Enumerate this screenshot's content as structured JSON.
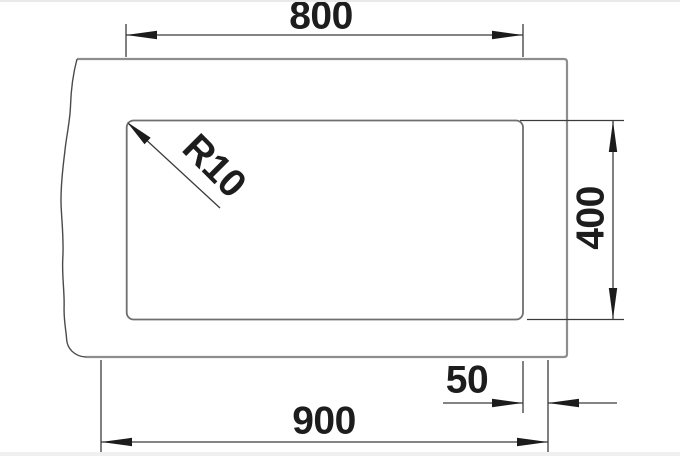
{
  "drawing": {
    "type": "technical-dimension-drawing",
    "object": "rectangular cut-out with rounded corners inside an outer outline broken on the left side",
    "dimensions": {
      "top_width": "800",
      "bottom_width": "900",
      "right_height": "400",
      "right_offset": "50",
      "corner_radius": "R10"
    },
    "colors": {
      "background": "#ffffff",
      "outline": "#8e8e8e",
      "inner_rect": "#6f6f6f",
      "break_line": "#4a4a4a",
      "dimension_lines": "#3b3b3b",
      "arrows_and_text": "#1c1c1c",
      "edge_strip": "#f0f0f0"
    }
  }
}
